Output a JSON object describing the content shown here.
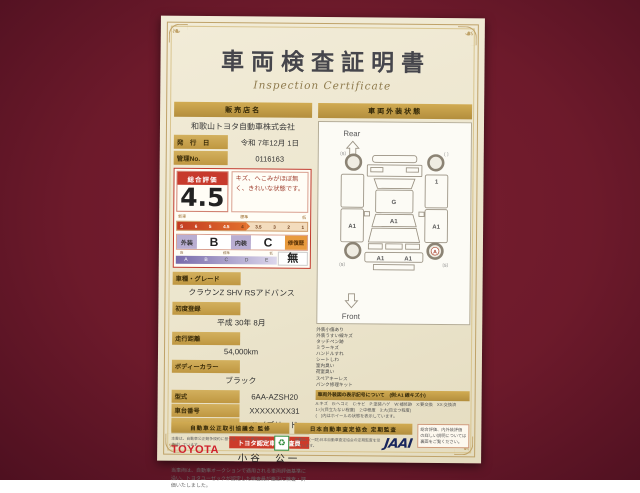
{
  "certificate": {
    "title": "車両検査証明書",
    "subtitle": "Inspection Certificate"
  },
  "dealer": {
    "header": "販売店名",
    "name": "和歌山トヨタ自動車株式会社",
    "issue_label": "発　行　日",
    "issue_value": "令和 7年12月 1日",
    "control_label": "管理No.",
    "control_value": "0116163"
  },
  "evaluation": {
    "label": "総合評価",
    "score": "4.5",
    "comment": "キズ、へこみがほぼ無く、きれいな状態です。",
    "scale_left": "新車",
    "scale_mid": "標準",
    "scale_right": "低",
    "scale_ticks": [
      "S",
      "6",
      "5",
      "4.5",
      "4",
      "3.5",
      "3",
      "2",
      "1"
    ],
    "exterior_label": "外装",
    "exterior_grade": "B",
    "interior_label": "内装",
    "interior_grade": "C",
    "repair_label": "修復歴",
    "repair_value": "無",
    "grade_high": "高",
    "grade_mid": "標準",
    "grade_low": "低",
    "grade_letters": [
      "A",
      "B",
      "C",
      "D",
      "E"
    ]
  },
  "details": [
    {
      "label": "車種・グレード",
      "value": "クラウンZ SHV RSアドバンス"
    },
    {
      "label": "初度登録",
      "value": "平成 30年 8月"
    },
    {
      "label": "走行距離",
      "value": "54,000km"
    },
    {
      "label": "ボディーカラー",
      "value": "ブラック"
    },
    {
      "label": "型式",
      "value": "6AA-AZSH20",
      "inline": true
    },
    {
      "label": "車台番号",
      "value": "XXXXXXXX31",
      "inline": true
    },
    {
      "label": "エンジン",
      "value": "ハイブリッド",
      "inline": true
    }
  ],
  "inspector": {
    "brand": "TOYOTA",
    "banner": "トヨタ認定車両検査員",
    "name": "小谷　公一"
  },
  "disclaimer": "当車両は、自動車オークションで適用される車両評価基準に沿い、トヨタユーゼックが認定した検査員が厳正に検査・評価いたしました。",
  "exterior": {
    "header": "車両外装状態",
    "rear_label": "Rear",
    "front_label": "Front",
    "marks": {
      "roof": "G",
      "windshield": "A1",
      "left_door": "A1",
      "right_door": "A1",
      "right_rear": "1",
      "bumper_left": "A1",
      "bumper_right": "A1",
      "front_right_wheel": "A",
      "rear_left_wheel_note": "〔5〕",
      "rear_right_wheel_note": "〔 〕",
      "front_left_wheel_note": "〔5〕",
      "front_right_wheel_note": "〔5〕"
    },
    "legend_items": [
      "外装小傷あり",
      "外装うすい線キズ",
      "タッチペン跡",
      "ミラーキズ",
      "ハンドルすれ",
      "シートしわ",
      "室内臭い",
      "荷室臭い",
      "スペアキーレス",
      "パンク修理キット"
    ],
    "symbols_banner": "車両外装図の表示記号について　(例:A1 線キズ小)",
    "symbols_notes": [
      "A:キズ　B:ヘコミ　C:サビ　P:塗装ハゲ　W:補修跡　X:要交換　XX:交換済",
      "1:小(目立たない程度)　2:中程度　3:大(目立つ程度)",
      "(　)内はホイールの状態を表示しています。"
    ]
  },
  "footer": {
    "left_banner": "自動車公正取引協議会 監修",
    "left_note": "本書は、自動車公正競争規約に基づき、公正な表示により作成しています。",
    "right_banner": "日本自動車査定協会 定期監査",
    "right_note": "本書は、(一財)日本自動車査定協会の定期監査を受けています。",
    "jaai_logo": "JAAI",
    "recycle_mark": "♻",
    "back_note": "総合評価、内外装評価の詳しい説明については裏面をご覧ください。"
  }
}
